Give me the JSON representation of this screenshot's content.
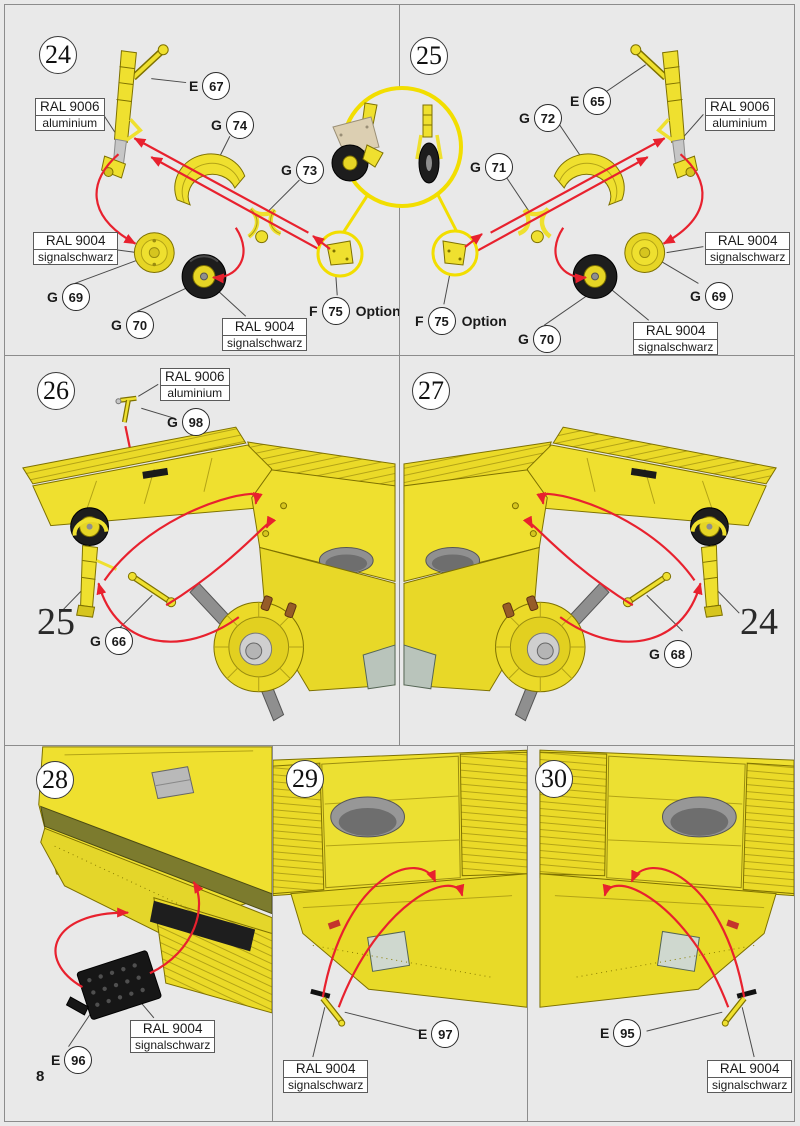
{
  "page": {
    "number": "8"
  },
  "colors": {
    "background": "#e9e9e9",
    "panel_border": "#8c8c8c",
    "part_yellow": "#EFE02F",
    "part_yellow_outline": "#7E7100",
    "aluminium_gray": "#C6C6C6",
    "tire_black": "#1d1d1d",
    "arrow_red": "#E8212E",
    "highlight_circle_yellow": "#F2DE00",
    "cover_plate_beige": "#DCCFB2"
  },
  "paints": {
    "aluminium": {
      "code": "RAL 9006",
      "name": "aluminium"
    },
    "signalschwarz": {
      "code": "RAL 9004",
      "name": "signalschwarz"
    }
  },
  "option_text": "Option",
  "steps": {
    "s24": {
      "number": "24",
      "parts": {
        "e67": {
          "letter": "E",
          "num": "67"
        },
        "g74": {
          "letter": "G",
          "num": "74"
        },
        "g73": {
          "letter": "G",
          "num": "73"
        },
        "g69": {
          "letter": "G",
          "num": "69"
        },
        "g70": {
          "letter": "G",
          "num": "70"
        },
        "f75": {
          "letter": "F",
          "num": "75"
        }
      }
    },
    "s25": {
      "number": "25",
      "parts": {
        "e65": {
          "letter": "E",
          "num": "65"
        },
        "g72": {
          "letter": "G",
          "num": "72"
        },
        "g71": {
          "letter": "G",
          "num": "71"
        },
        "g69": {
          "letter": "G",
          "num": "69"
        },
        "g70": {
          "letter": "G",
          "num": "70"
        },
        "f75": {
          "letter": "F",
          "num": "75"
        }
      }
    },
    "s26": {
      "number": "26",
      "ref_step": "25",
      "parts": {
        "g98": {
          "letter": "G",
          "num": "98"
        },
        "g66": {
          "letter": "G",
          "num": "66"
        }
      }
    },
    "s27": {
      "number": "27",
      "ref_step": "24",
      "parts": {
        "g68": {
          "letter": "G",
          "num": "68"
        }
      }
    },
    "s28": {
      "number": "28",
      "parts": {
        "e96": {
          "letter": "E",
          "num": "96"
        }
      }
    },
    "s29": {
      "number": "29",
      "parts": {
        "e97": {
          "letter": "E",
          "num": "97"
        }
      }
    },
    "s30": {
      "number": "30",
      "parts": {
        "e95": {
          "letter": "E",
          "num": "95"
        }
      }
    }
  }
}
